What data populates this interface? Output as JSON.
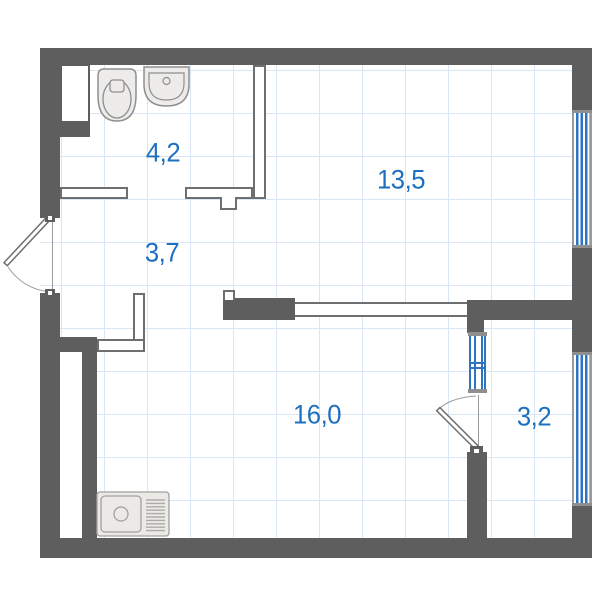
{
  "plan": {
    "type": "apartment-floor-plan",
    "rooms": [
      {
        "id": "bathroom",
        "area": "4,2"
      },
      {
        "id": "hallway",
        "area": "3,7"
      },
      {
        "id": "living-room",
        "area": "13,5"
      },
      {
        "id": "kitchen-living",
        "area": "16,0"
      },
      {
        "id": "balcony",
        "area": "3,2"
      }
    ],
    "colors": {
      "wall": "#5e5e5e",
      "thin_wall_stroke": "#6f6f6f",
      "grid_line": "#d9e6f6",
      "label_text": "#1d6fc0",
      "window_glass_stripe": "#2e74c0",
      "window_frame": "#9a9a9a",
      "fixture_fill": "#edecea",
      "fixture_stroke": "#8f8f8f"
    }
  }
}
